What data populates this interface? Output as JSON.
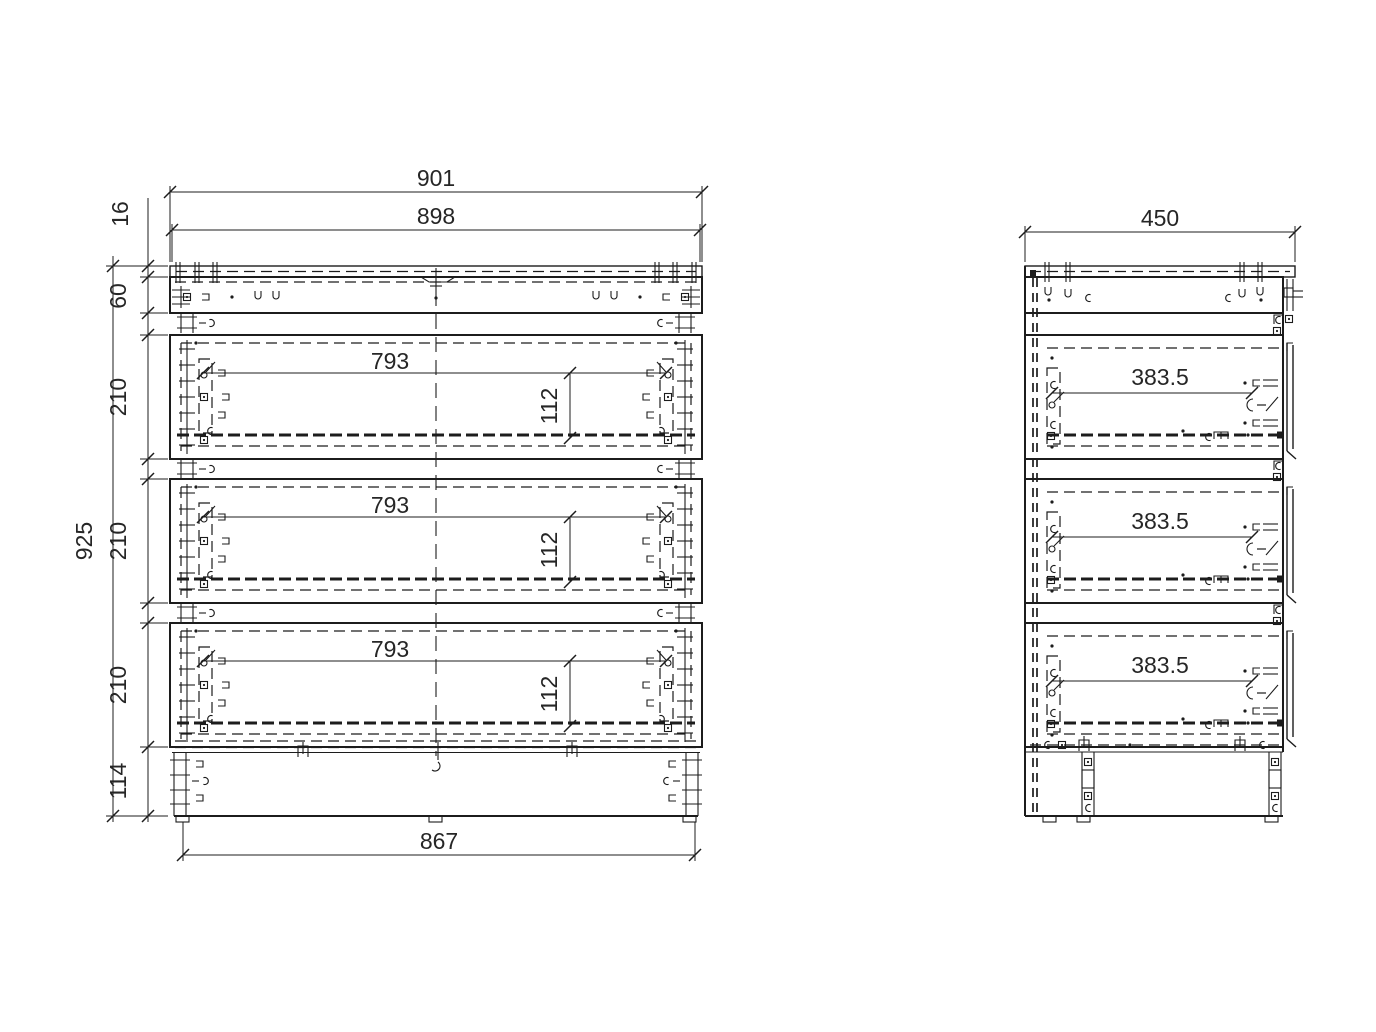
{
  "drawing": {
    "front_view": {
      "dims": {
        "overall_width": "901",
        "top_width": "898",
        "top_panel_thickness": "16",
        "top_rail_height": "60",
        "overall_height": "925",
        "drawer_height_1": "210",
        "drawer_height_2": "210",
        "drawer_height_3": "210",
        "plinth_height": "114",
        "base_width": "867",
        "drawer_width_1": "793",
        "drawer_width_2": "793",
        "drawer_width_3": "793",
        "drawer_box_height_1": "112",
        "drawer_box_height_2": "112",
        "drawer_box_height_3": "112"
      }
    },
    "side_view": {
      "dims": {
        "depth": "450",
        "drawer_depth_1": "383.5",
        "drawer_depth_2": "383.5",
        "drawer_depth_3": "383.5"
      }
    },
    "colors": {
      "line": "#1c1c1c",
      "text": "#262626",
      "background": "#ffffff"
    }
  }
}
